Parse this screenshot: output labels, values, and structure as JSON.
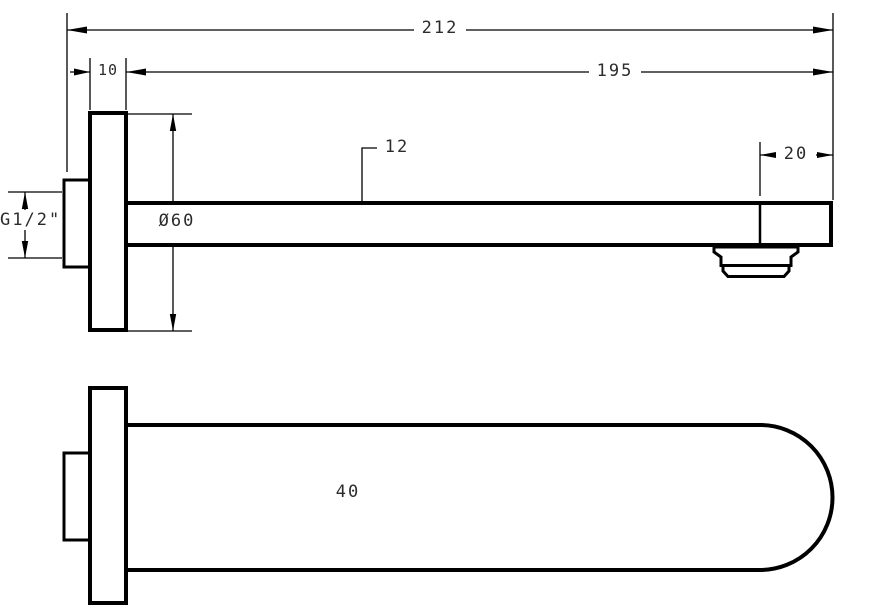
{
  "drawing": {
    "background": "#ffffff",
    "line_color": "#000000",
    "text_color": "#2b2b2b"
  },
  "dimensions": {
    "overall_length": "212",
    "spout_length": "195",
    "flange_thickness": "10",
    "spout_height": "12",
    "tip_section_length": "20",
    "flange_diameter": "Ø60",
    "thread_size": "G1/2\"",
    "spout_width": "40"
  }
}
